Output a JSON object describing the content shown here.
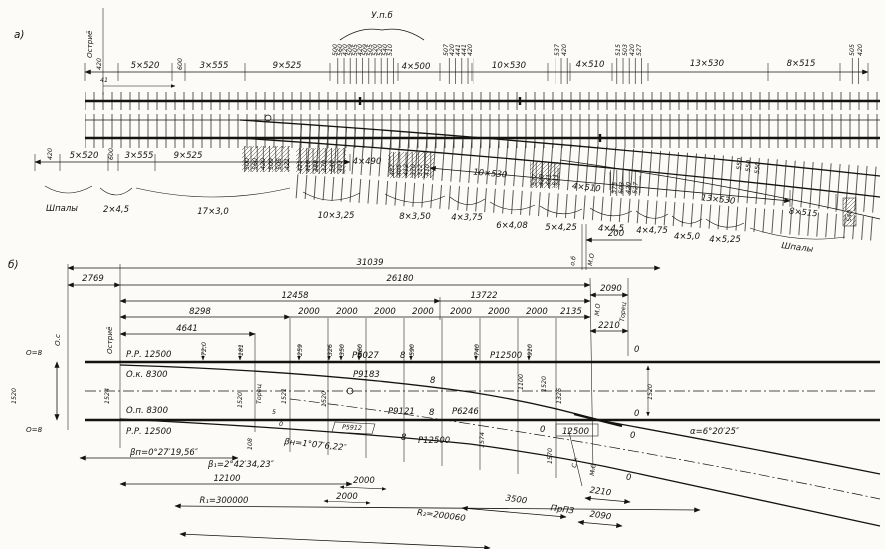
{
  "a": {
    "tag": "а)",
    "ostrie": "Остриё",
    "upb": "У.п.б",
    "d41": "41",
    "top": [
      "420",
      "5×520",
      "600",
      "3×555",
      "9×525",
      "4×500",
      "10×530",
      "4×510",
      "13×530",
      "8×515"
    ],
    "ts1": [
      "500",
      "560",
      "420",
      "509",
      "505",
      "420",
      "509",
      "505",
      "520",
      "520",
      "540",
      "510"
    ],
    "ts2": [
      "507",
      "420",
      "441",
      "441",
      "420"
    ],
    "ts3": [
      "537",
      "420"
    ],
    "ts4": [
      "515",
      "503",
      "420",
      "527"
    ],
    "ts5": [
      "505",
      "420"
    ],
    "bot": [
      "420",
      "5×520",
      "600",
      "3×555",
      "9×525",
      "4×490",
      "10×530",
      "4×510",
      "13×530",
      "8×515"
    ],
    "bs1": [
      "500",
      "560",
      "420",
      "509",
      "505",
      "421"
    ],
    "bs2": [
      "421",
      "410",
      "388",
      "370",
      "540",
      "493"
    ],
    "bs3": [
      "487",
      "405",
      "412",
      "370",
      "312",
      "410"
    ],
    "bs4": [
      "537",
      "420",
      "441",
      "511"
    ],
    "bs5": [
      "375",
      "503",
      "420",
      "527"
    ],
    "bs6": [
      "550",
      "550",
      "550"
    ],
    "b540": "540",
    "shpaly": "Шпалы",
    "shpaly2": "Шпалы",
    "br": [
      "2×4,5",
      "17×3,0",
      "10×3,25",
      "8×3,50",
      "4×3,75",
      "6×4,08",
      "5×4,25",
      "4×4,5",
      "4×4,75",
      "4×5,0",
      "4×5,25"
    ],
    "d200": "200",
    "ob": "о.б",
    "mo": "М.О"
  },
  "b": {
    "tag": "б)",
    "c31039": "31039",
    "c2769": "2769",
    "c26180": "26180",
    "c2090": "2090",
    "c12458": "12458",
    "c13722": "13722",
    "c8298": "8298",
    "c2000": "2000",
    "c2135": "2135",
    "c2210": "2210",
    "c4641": "4641",
    "os": "О.с",
    "o8": "О=8",
    "ostrie": "Остриё",
    "rr": "Р.Р. 12500",
    "ok": "О.к. 8300",
    "op": "О.п. 8300",
    "g1520": "1520",
    "v1524": "1524",
    "ord": [
      "72,0",
      "181",
      "259",
      "326",
      "350",
      "460",
      "590",
      "740",
      "910"
    ],
    "torec": "Торец",
    "v1521": "1521",
    "n5": "5",
    "v108": "108",
    "r6027": "Р6027",
    "r9183": "Р9183",
    "r12500": "Р12500",
    "n8": "8",
    "v1100": "1100",
    "v1326": "1326",
    "r9121": "Р9121",
    "r6246": "Р6246",
    "r5912": "Р5912",
    "v1574": "1574",
    "v1570": "1570",
    "b12500": "12500",
    "n0": "0",
    "sk": "С.к",
    "mo": "М.О",
    "d2210": "2210",
    "d3500": "3500",
    "prp": "ПрПЗ",
    "d2090": "2090",
    "r2": "R₂=200060",
    "beta_p": "βп=0°27′19,56″",
    "beta_n": "βн=1°07′6,22″",
    "beta_1": "β₁=2°42′34,23″",
    "d12100": "12100",
    "r1": "R₁=300000",
    "d2000": "2000",
    "alpha": "α=6°20′25″"
  }
}
